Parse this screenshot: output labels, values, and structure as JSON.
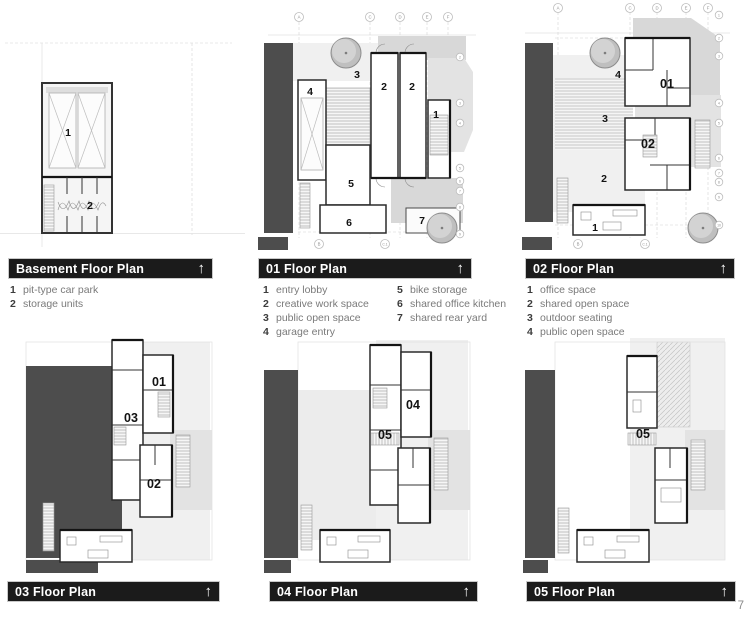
{
  "page": {
    "number": "7"
  },
  "icons": {
    "up_arrow": "↑"
  },
  "panels": [
    {
      "id": "basement",
      "title": "Basement Floor Plan",
      "legend": [
        {
          "num": "1",
          "label": "pit-type car park"
        },
        {
          "num": "2",
          "label": "storage units"
        }
      ],
      "room_labels": [
        "1",
        "2"
      ]
    },
    {
      "id": "floor01",
      "title": "01 Floor Plan",
      "legend": [
        {
          "num": "1",
          "label": "entry lobby"
        },
        {
          "num": "2",
          "label": "creative work space"
        },
        {
          "num": "3",
          "label": "public open space"
        },
        {
          "num": "4",
          "label": "garage entry"
        },
        {
          "num": "5",
          "label": "bike storage"
        },
        {
          "num": "6",
          "label": "shared office kitchen"
        },
        {
          "num": "7",
          "label": "shared rear yard"
        }
      ],
      "room_labels": [
        "4",
        "3",
        "2",
        "2",
        "1",
        "5",
        "6",
        "7"
      ],
      "grid_top": [
        "A",
        "C",
        "D",
        "E",
        "F"
      ],
      "grid_bottom": [
        "B",
        "C.1"
      ],
      "grid_right": [
        "2",
        "3",
        "4",
        "5",
        "6",
        "7",
        "8",
        "9"
      ]
    },
    {
      "id": "floor02",
      "title": "02 Floor Plan",
      "legend": [
        {
          "num": "1",
          "label": "office space"
        },
        {
          "num": "2",
          "label": "shared open space"
        },
        {
          "num": "3",
          "label": "outdoor seating"
        },
        {
          "num": "4",
          "label": "public open space"
        }
      ],
      "room_labels": [
        "4",
        "3",
        "2",
        "1"
      ],
      "unit_labels": [
        "01",
        "02"
      ],
      "grid_top": [
        "A",
        "C",
        "D",
        "E",
        "F"
      ],
      "grid_bottom": [
        "B",
        "C.1"
      ],
      "grid_right": [
        "1",
        "2",
        "3",
        "4",
        "5",
        "6",
        "7",
        "8",
        "9",
        "10"
      ]
    },
    {
      "id": "floor03",
      "title": "03 Floor Plan",
      "unit_labels": [
        "01",
        "03",
        "02"
      ]
    },
    {
      "id": "floor04",
      "title": "04 Floor Plan",
      "unit_labels": [
        "04",
        "05"
      ]
    },
    {
      "id": "floor05",
      "title": "05 Floor Plan",
      "unit_labels": [
        "05"
      ]
    }
  ]
}
